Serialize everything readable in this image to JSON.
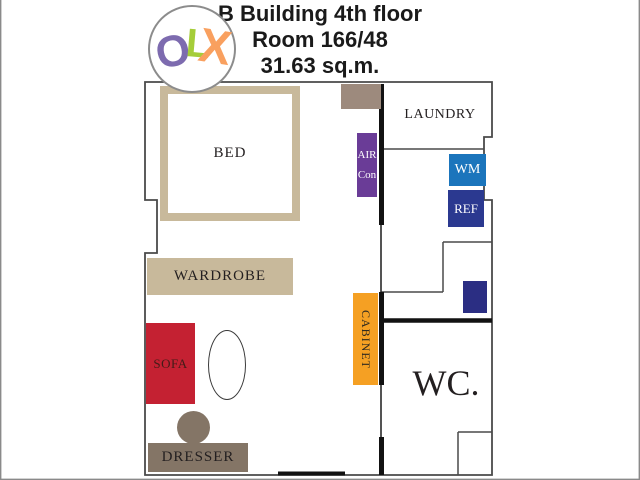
{
  "title": {
    "line1": "B Building 4th floor",
    "line2": "Room 166/48",
    "line3": "31.63 sq.m."
  },
  "logo": {
    "letters": {
      "o": "O",
      "l": "L",
      "x": "X"
    },
    "colors": {
      "o": "#7d6baf",
      "l": "#a5cd39",
      "x": "#f9a05f"
    }
  },
  "floorplan": {
    "rooms": {
      "laundry": {
        "label": "LAUNDRY"
      },
      "wc": {
        "label": "WC."
      }
    },
    "furniture": {
      "bed": {
        "label": "BED",
        "color": "#c8b99b"
      },
      "wardrobe": {
        "label": "WARDROBE",
        "color": "#c8b99b"
      },
      "sofa": {
        "label": "SOFA",
        "color": "#c42132"
      },
      "dresser": {
        "label": "DRESSER",
        "color": "#847566"
      },
      "stool": {
        "color": "#847566"
      },
      "cabinet": {
        "label": "CABINET",
        "color": "#f5a023"
      },
      "aircon": {
        "label_line1": "AIR",
        "label_line2": "Con",
        "color": "#6a3c97"
      },
      "washing_machine": {
        "label": "WM",
        "color": "#1b75bc"
      },
      "refrigerator": {
        "label": "REF",
        "color": "#2b3990"
      },
      "door_panel": {
        "color": "#9d8a7d"
      },
      "storage_box": {
        "color": "#2b2e83"
      }
    },
    "wall_colors": {
      "thin": "#4a4a4a",
      "thick": "#121212"
    }
  }
}
